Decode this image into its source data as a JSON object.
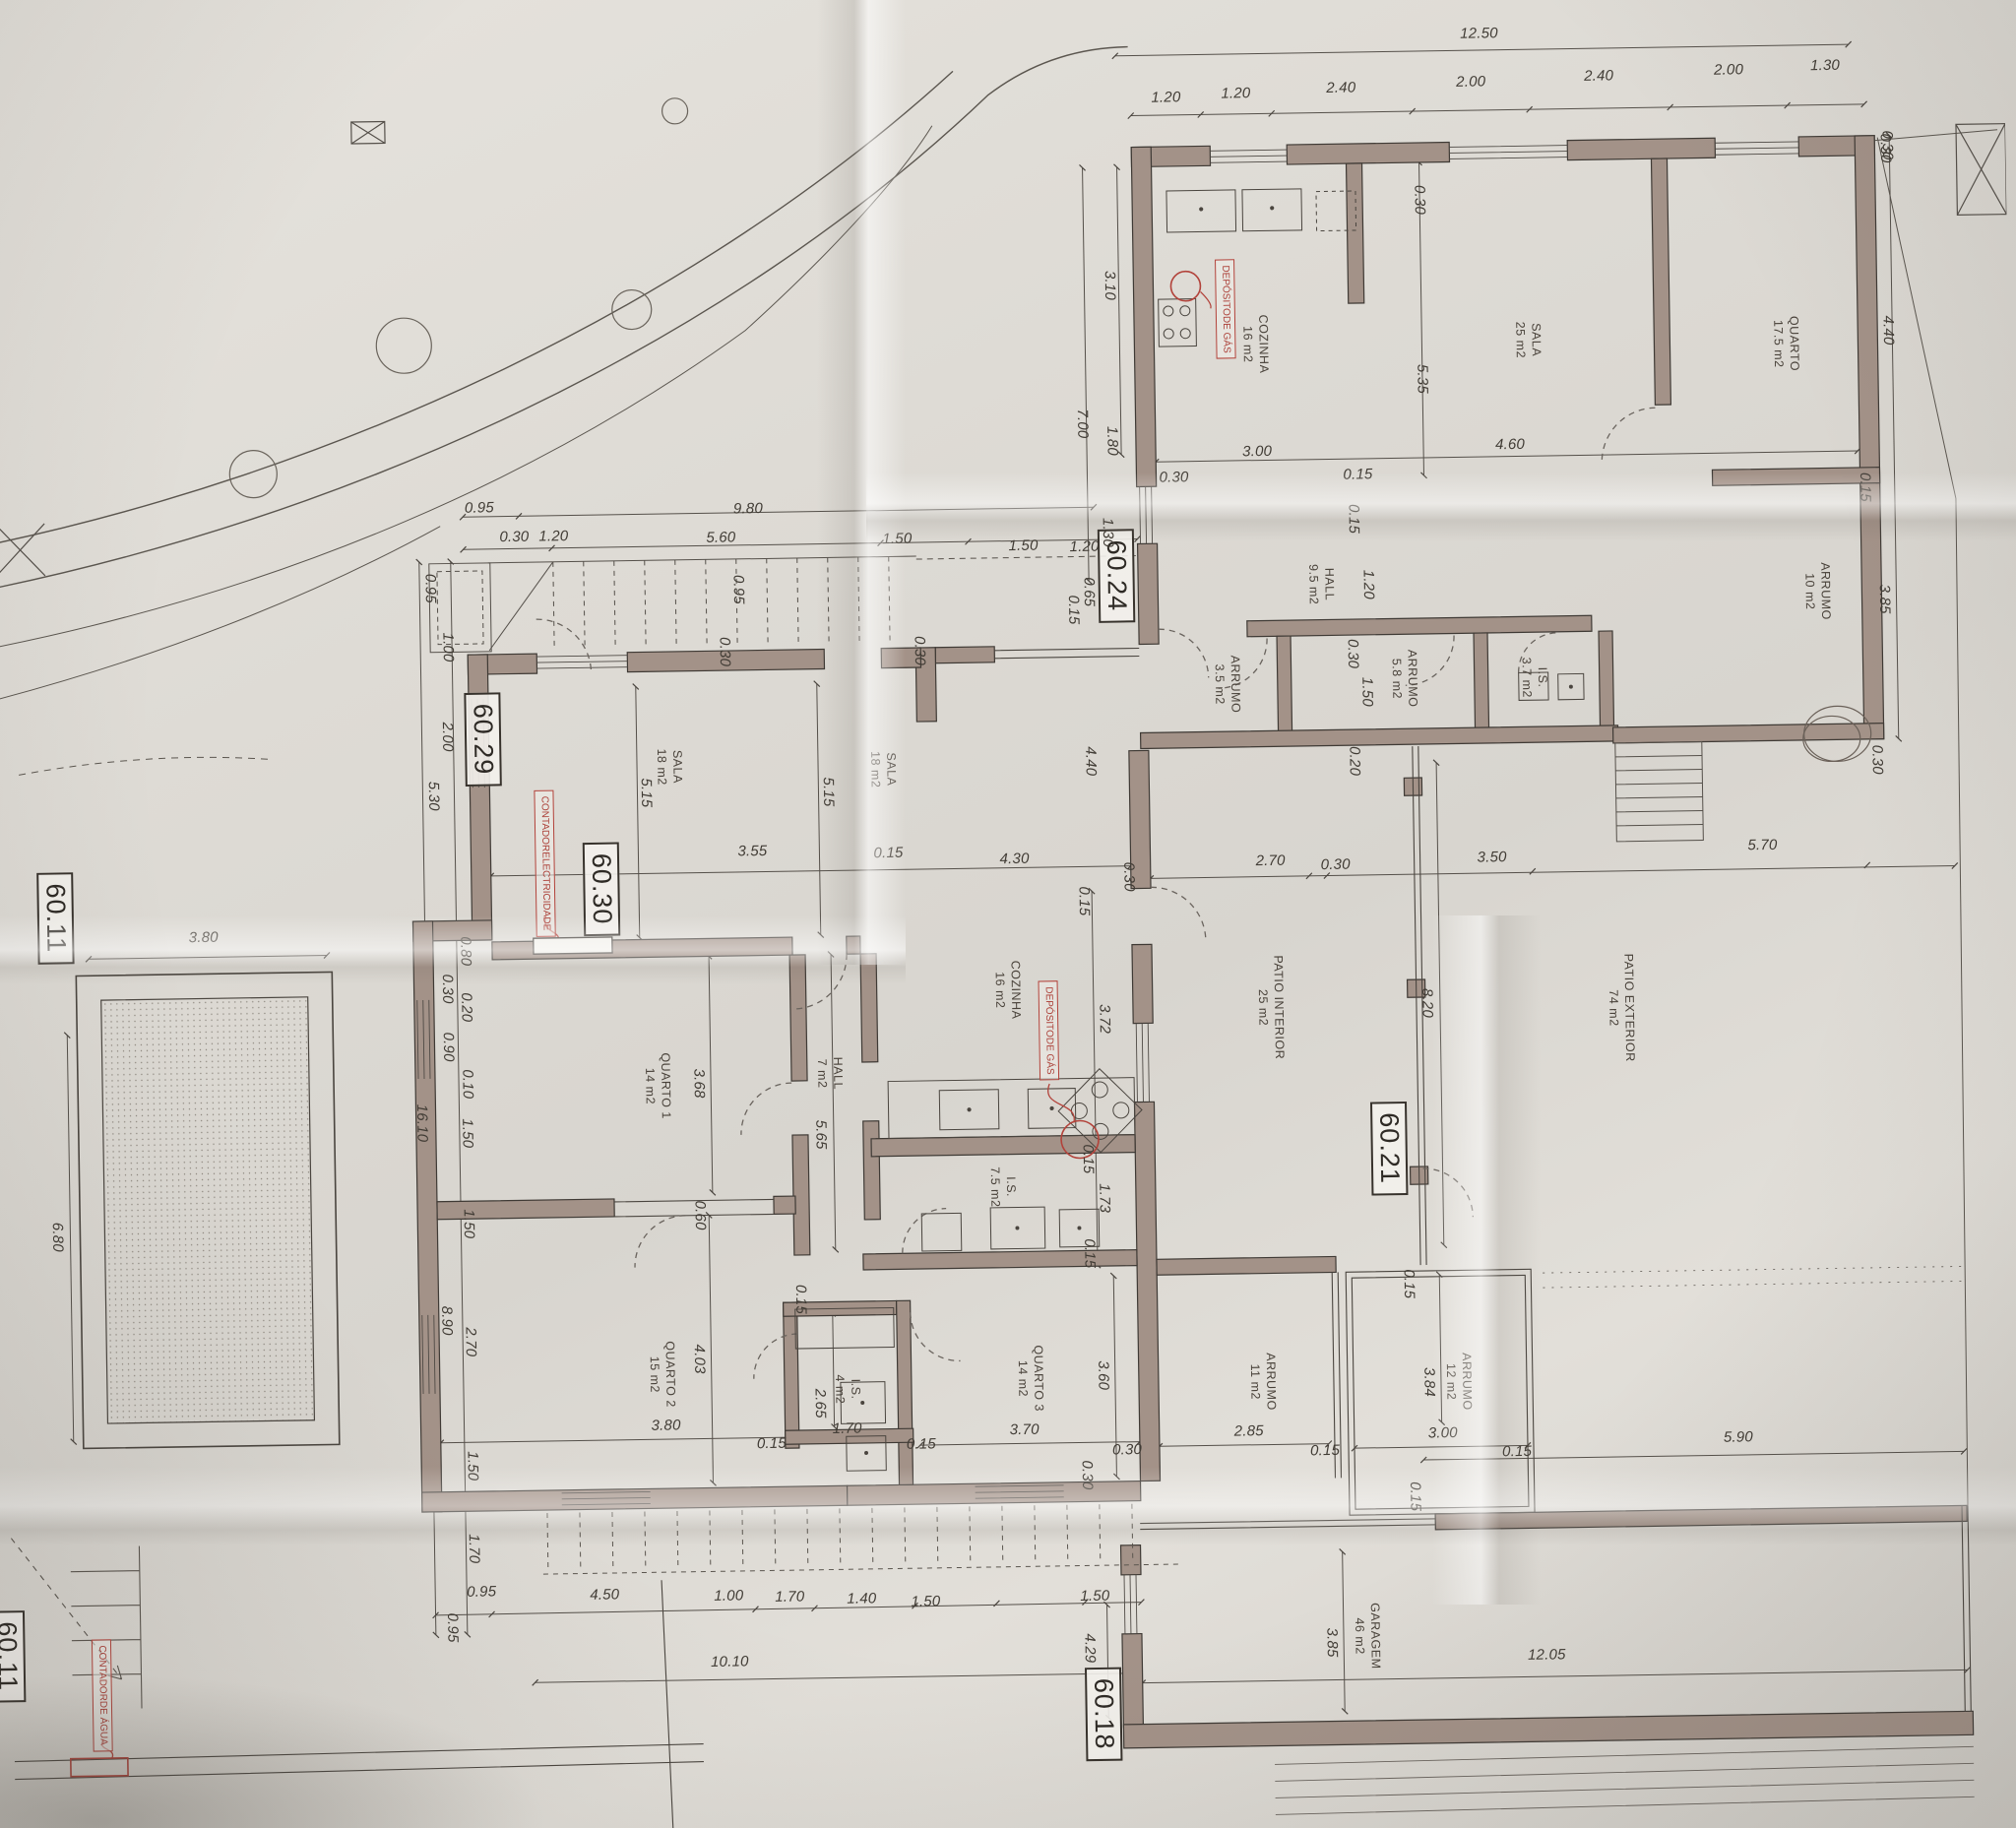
{
  "drawing": {
    "type_note": "architectural floor plan photo"
  },
  "red": {
    "gas": [
      "DEPÓSITO",
      "DE GÁS"
    ],
    "elec": [
      "CONTADOR",
      "ELECTRICIDADE"
    ],
    "agua": [
      "CONTADOR",
      "DE ÁGUA"
    ]
  },
  "markers": {
    "m6024": "60.24",
    "m6029": "60.29",
    "m6030": "60.30",
    "m6011": "60.11",
    "m6021": "60.21",
    "m6018": "60.18"
  },
  "rooms": [
    {
      "name": "COZINHA",
      "area": "16 m2"
    },
    {
      "name": "SALA",
      "area": "25 m2"
    },
    {
      "name": "QUARTO",
      "area": "17.5 m2"
    },
    {
      "name": "ARRUMO",
      "area": "10 m2"
    },
    {
      "name": "HALL",
      "area": "9.5 m2"
    },
    {
      "name": "ARRUMO",
      "area": "3.5 m2"
    },
    {
      "name": "ARRUMO",
      "area": "5.8 m2"
    },
    {
      "name": "I.S.",
      "area": "3.7 m2"
    },
    {
      "name": "SALA",
      "area": "18 m2"
    },
    {
      "name": "SALA",
      "area": "18 m2"
    },
    {
      "name": "COZINHA",
      "area": "16 m2"
    },
    {
      "name": "HALL",
      "area": "7 m2"
    },
    {
      "name": "QUARTO 1",
      "area": "14 m2"
    },
    {
      "name": "I.S.",
      "area": "7.5 m2"
    },
    {
      "name": "QUARTO 2",
      "area": "15 m2"
    },
    {
      "name": "I.S.",
      "area": "4 m2"
    },
    {
      "name": "QUARTO 3",
      "area": "14 m2"
    },
    {
      "name": "ARRUMO",
      "area": "11 m2"
    },
    {
      "name": "ARRUMO",
      "area": "12 m2"
    },
    {
      "name": "PATIO INTERIOR",
      "area": "25 m2"
    },
    {
      "name": "PATIO EXTERIOR",
      "area": "74 m2"
    },
    {
      "name": "GARAGEM",
      "area": "46 m2"
    }
  ],
  "dims": {
    "top": [
      "12.50",
      "1.20",
      "1.20",
      "2.40",
      "2.00",
      "2.40",
      "2.00",
      "1.30",
      "0.30"
    ],
    "ubLeft": [
      "3.10",
      "7.00",
      "1.80"
    ],
    "ubInner": [
      "0.30",
      "5.35",
      "3.00",
      "4.60",
      "0.30",
      "0.15",
      "0.15",
      "1.20",
      "1.30",
      "1.20",
      "1.50",
      "0.65",
      "0.15",
      "0.30",
      "1.50",
      "0.20",
      "4.40"
    ],
    "ubRight": [
      "0.30",
      "4.40",
      "0.15",
      "3.85",
      "0.30"
    ],
    "mhTop": [
      "0.95",
      "9.80",
      "0.30",
      "1.20",
      "5.60",
      "1.50",
      "0.95",
      "0.95",
      "0.30",
      "0.30",
      "1.00"
    ],
    "mhLeft": [
      "16.10",
      "2.00",
      "5.30",
      "0.80",
      "0.30",
      "0.20",
      "0.90",
      "0.10",
      "1.50",
      "1.50",
      "2.70",
      "8.90",
      "1.50",
      "1.70",
      "0.95"
    ],
    "sala": [
      "5.15",
      "5.15",
      "3.55",
      "0.15",
      "4.30",
      "0.30",
      "0.15",
      "3.72",
      "0.15",
      "1.73",
      "0.15"
    ],
    "rooms1": [
      "3.68",
      "0.60",
      "5.65",
      "0.15",
      "4.03",
      "3.80",
      "0.15",
      "2.65",
      "1.70",
      "0.15",
      "3.60",
      "3.70",
      "0.30",
      "0.30"
    ],
    "east": [
      "2.70",
      "0.30",
      "3.50",
      "5.70",
      "8.20",
      "0.15",
      "2.85",
      "0.15",
      "3.84",
      "3.00",
      "0.15",
      "0.15",
      "5.90"
    ],
    "bottom": [
      "0.95",
      "4.50",
      "1.00",
      "1.70",
      "1.40",
      "1.50",
      "10.10",
      "4.29",
      "1.50",
      "3.85",
      "12.05"
    ],
    "pool": [
      "3.80",
      "6.80"
    ]
  }
}
